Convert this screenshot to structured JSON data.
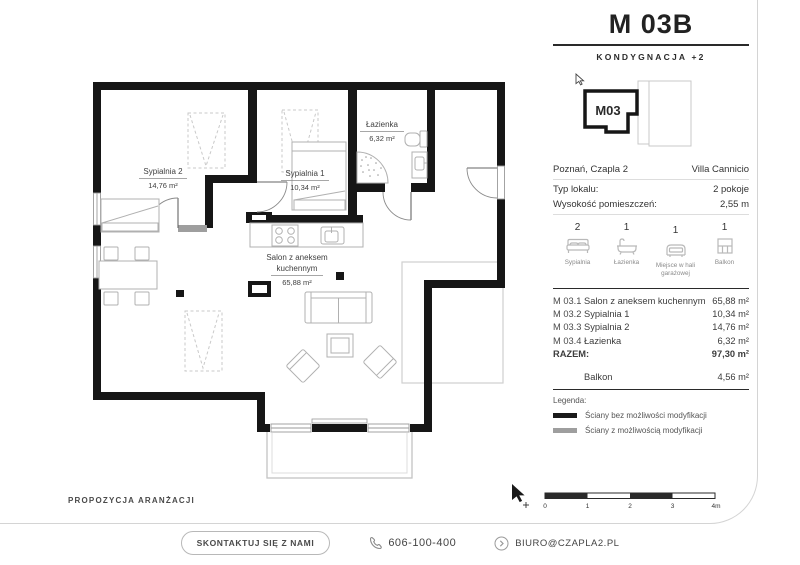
{
  "header": {
    "title": "M 03B",
    "subtitle": "KONDYGNACJA +2",
    "unit_label": "M03"
  },
  "info": {
    "location": "Poznań, Czapla 2",
    "investment": "Villa Cannicio",
    "rows": [
      {
        "label": "Typ lokalu:",
        "value": "2 pokoje"
      },
      {
        "label": "Wysokość pomieszczeń:",
        "value": "2,55 m"
      }
    ]
  },
  "features": [
    {
      "count": "2",
      "label": "Sypialnia",
      "icon": "bed-icon"
    },
    {
      "count": "1",
      "label": "Łazienka",
      "icon": "bathtub-icon"
    },
    {
      "count": "1",
      "label": "Miejsce w hali garażowej",
      "icon": "car-icon"
    },
    {
      "count": "1",
      "label": "Balkon",
      "icon": "balcony-icon"
    }
  ],
  "rooms": [
    {
      "code": "M 03.1",
      "name": "Salon z aneksem kuchennym",
      "area": "65,88 m²"
    },
    {
      "code": "M 03.2",
      "name": "Sypialnia 1",
      "area": "10,34 m²"
    },
    {
      "code": "M 03.3",
      "name": "Sypialnia 2",
      "area": "14,76 m²"
    },
    {
      "code": "M 03.4",
      "name": "Łazienka",
      "area": "6,32 m²"
    }
  ],
  "total": {
    "label": "RAZEM:",
    "area": "97,30 m²"
  },
  "balcony_row": {
    "name": "Balkon",
    "area": "4,56 m²"
  },
  "legend": {
    "title": "Legenda:",
    "items": [
      {
        "label": "Ściany bez możliwości modyfikacji",
        "color": "#1a1a1a"
      },
      {
        "label": "Ściany z możliwością modyfikacji",
        "color": "#9e9e9e"
      }
    ]
  },
  "plan": {
    "note": "PROPOZYCJA ARANŻACJI",
    "rooms": {
      "sypialnia2": {
        "name": "Sypialnia 2",
        "area": "14,76 m²"
      },
      "sypialnia1": {
        "name": "Sypialnia 1",
        "area": "10,34 m²"
      },
      "lazienka": {
        "name": "Łazienka",
        "area": "6,32 m²"
      },
      "salon": {
        "line1": "Salon z aneksem",
        "line2": "kuchennym",
        "area": "65,88 m²"
      }
    }
  },
  "scalebar": {
    "labels": [
      "0",
      "1",
      "2",
      "3",
      "4m"
    ]
  },
  "footer": {
    "contact": "SKONTAKTUJ SIĘ Z NAMI",
    "phone": "606-100-400",
    "email": "BIURO@CZAPLA2.PL"
  },
  "colors": {
    "wall": "#161616",
    "wall_modifiable": "#9e9e9e",
    "furniture_line": "#b0b0b0"
  }
}
